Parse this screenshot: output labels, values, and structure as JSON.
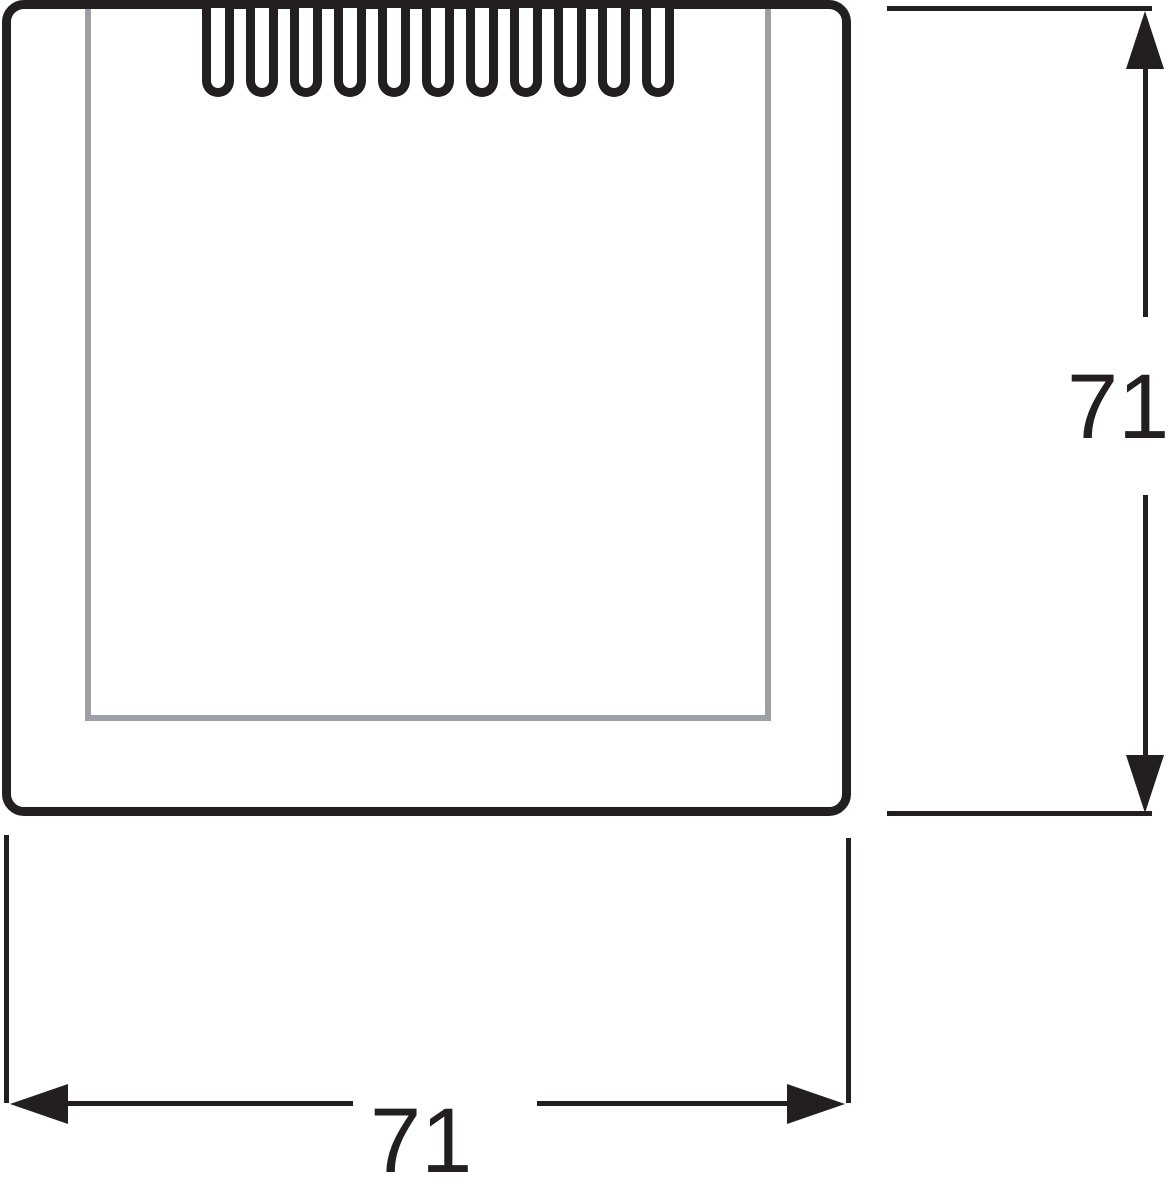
{
  "drawing": {
    "type": "technical-dimension-drawing",
    "subject": "square cover plate with ventilation slots",
    "vent_slot_count": 11,
    "colors": {
      "line": "#231f20",
      "inner_frame": "#9ca0a4",
      "background": "#ffffff"
    }
  },
  "dimensions": {
    "height": {
      "label": "71"
    },
    "width": {
      "label": "71"
    }
  }
}
